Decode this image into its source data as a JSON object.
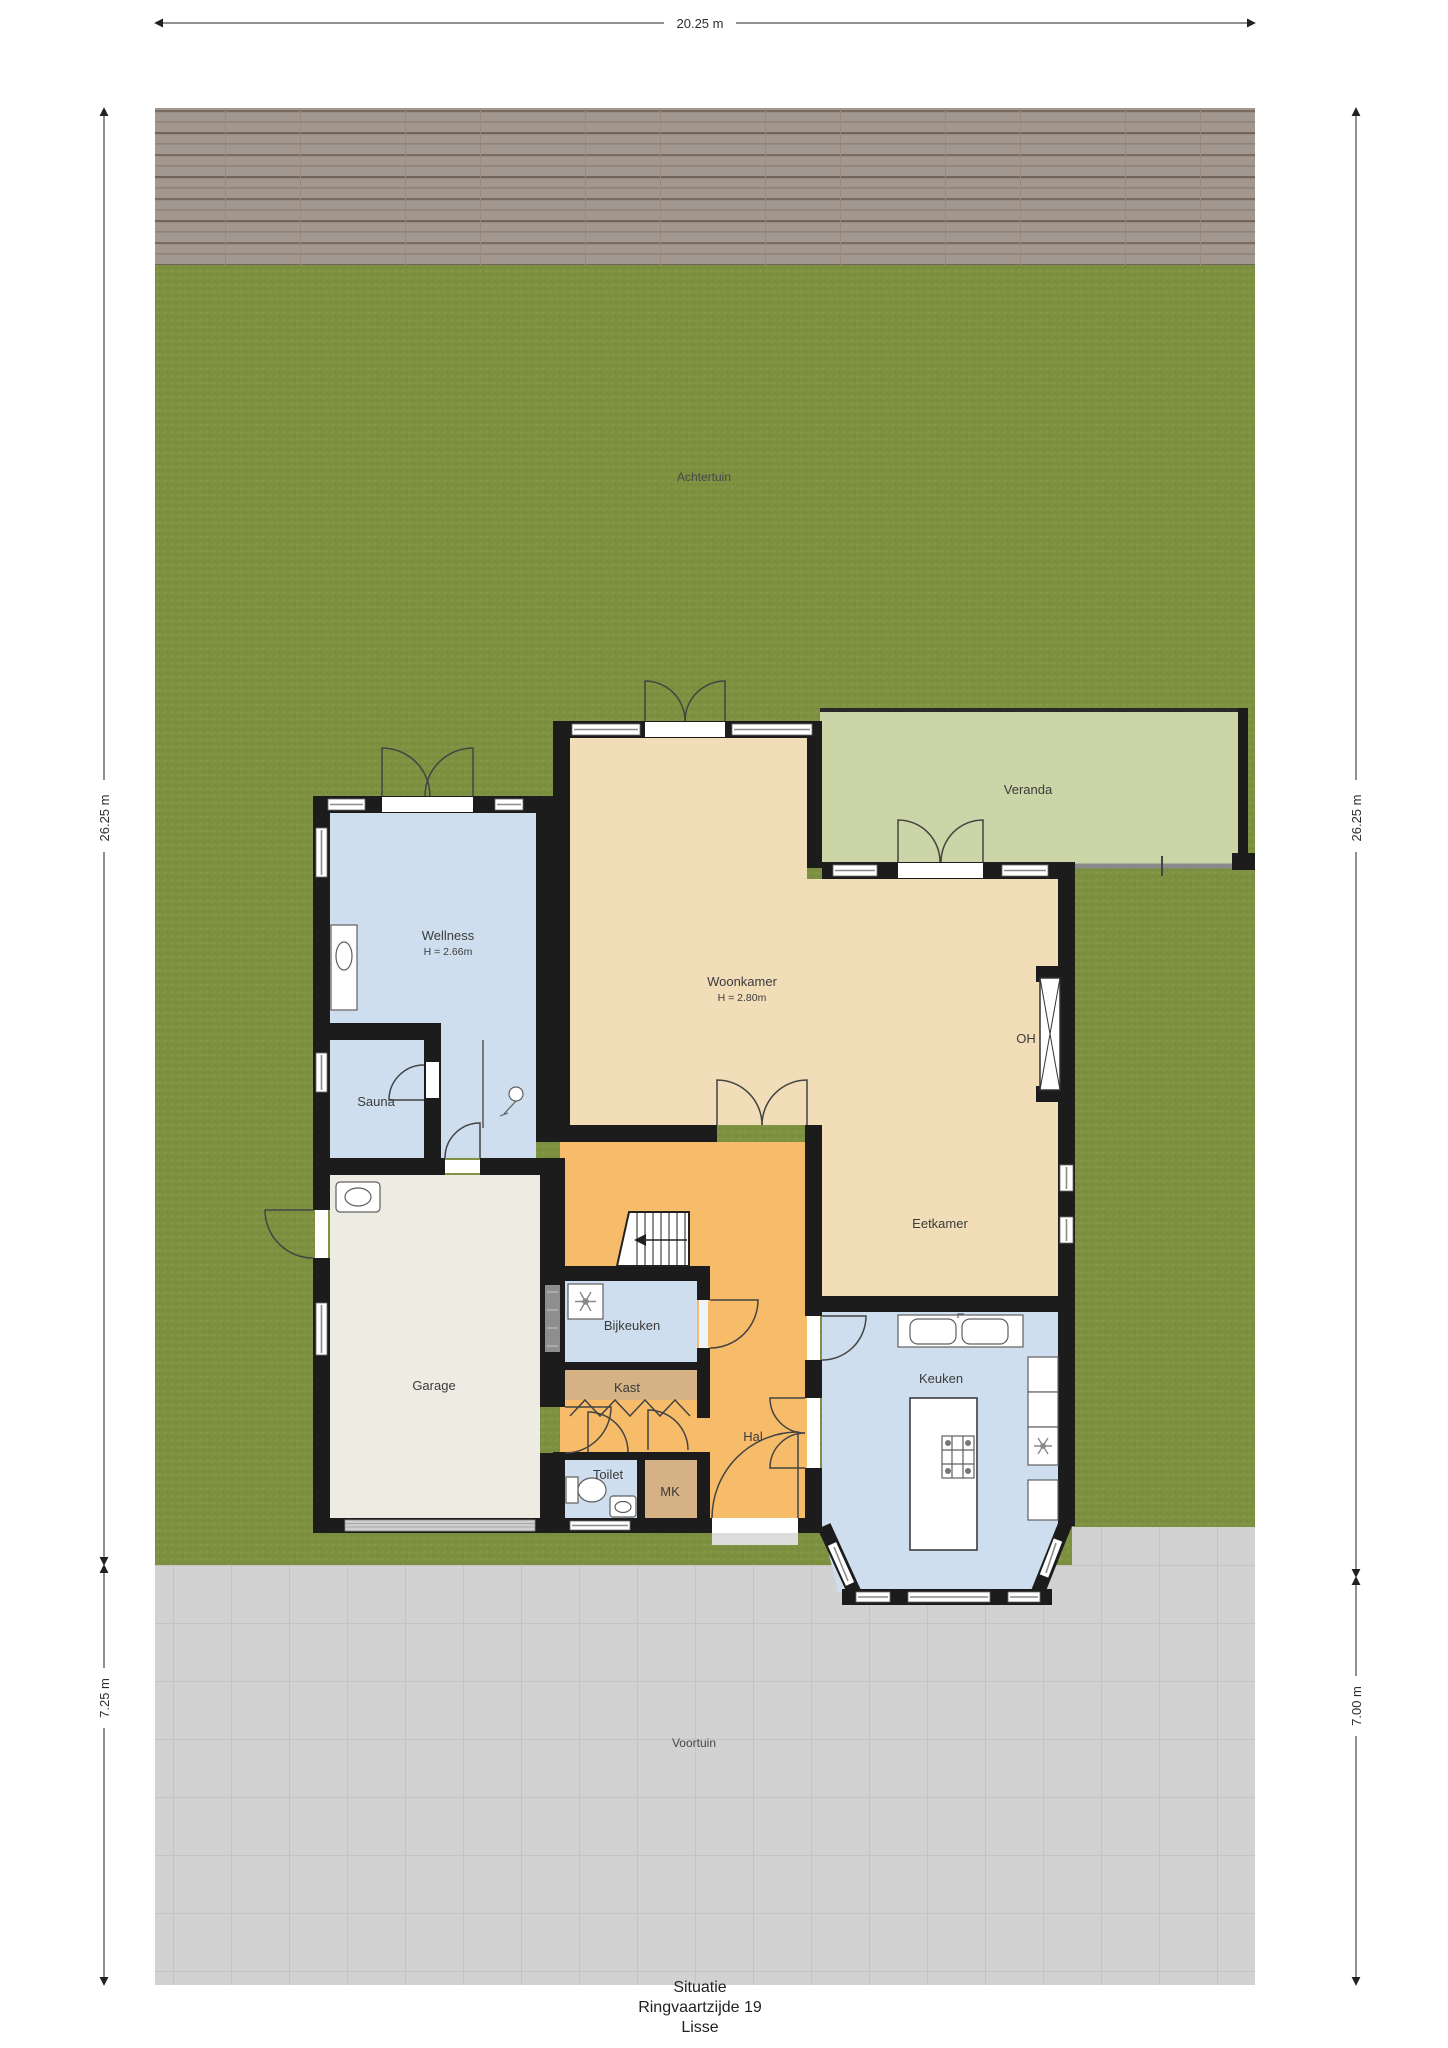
{
  "site": {
    "back_garden": "Achtertuin",
    "front_garden": "Voortuin",
    "veranda": "Veranda"
  },
  "dimensions": {
    "top_width": "20.25 m",
    "left_upper": "26.25 m",
    "left_lower": "7.25 m",
    "right_upper": "26.25 m",
    "right_lower": "7.00 m"
  },
  "rooms": {
    "wellness": {
      "label": "Wellness",
      "ceiling_height": "H = 2.66m"
    },
    "sauna": {
      "label": "Sauna"
    },
    "woonkamer": {
      "label": "Woonkamer",
      "ceiling_height": "H = 2.80m"
    },
    "eetkamer": {
      "label": "Eetkamer"
    },
    "keuken": {
      "label": "Keuken"
    },
    "hal": {
      "label": "Hal"
    },
    "bijkeuken": {
      "label": "Bijkeuken"
    },
    "kast": {
      "label": "Kast"
    },
    "toilet": {
      "label": "Toilet"
    },
    "mk": {
      "label": "MK"
    },
    "garage": {
      "label": "Garage"
    },
    "fireplace": {
      "label": "OH"
    }
  },
  "title": {
    "line1": "Situatie",
    "line2": "Ringvaartzijde 19",
    "line3": "Lisse"
  },
  "colors": {
    "grass": "#7d9140",
    "deck": "#a39890",
    "paving": "#d2d2d2",
    "veranda_floor": "#cbd5a8",
    "living_floor": "#f1ddb8",
    "hall_floor": "#f7bc69",
    "wet_room_floor": "#cfdeee",
    "closet_floor": "#d4b285",
    "garage_floor": "#edebe2",
    "wall": "#1c1c1c"
  }
}
